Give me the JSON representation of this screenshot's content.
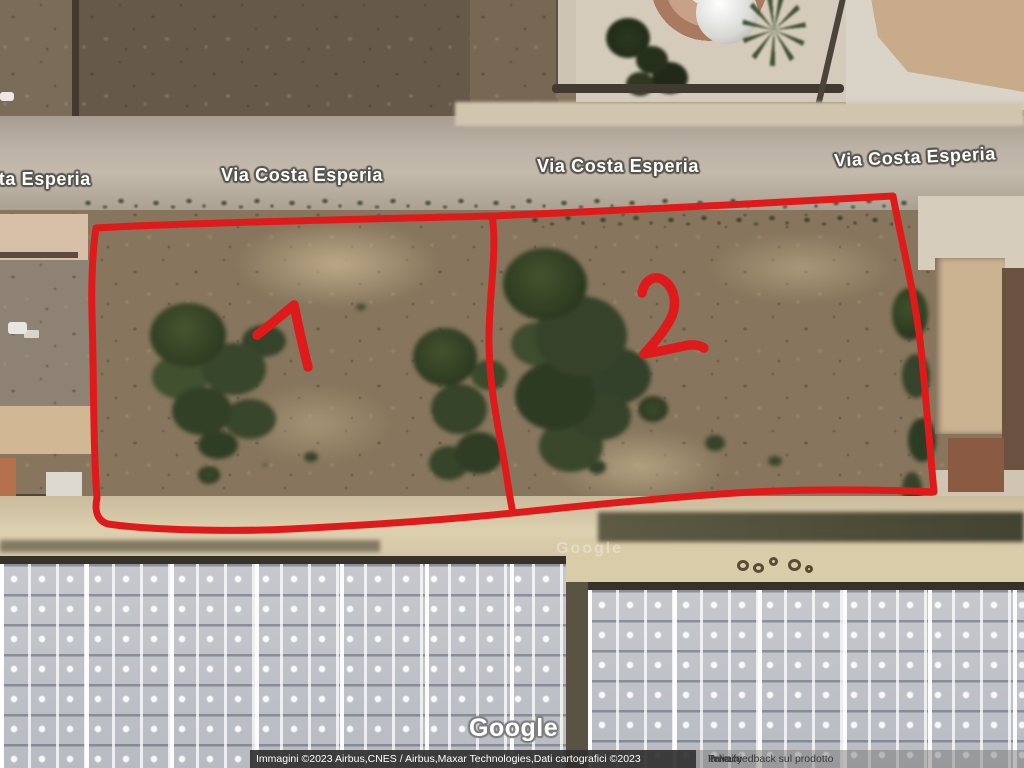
{
  "map": {
    "street_labels": [
      {
        "text": "Costa Esperia"
      },
      {
        "text": "Via Costa Esperia"
      },
      {
        "text": "Via Costa Esperia"
      },
      {
        "text": "Via Costa Esperia"
      }
    ],
    "parcels": [
      {
        "number": "1"
      },
      {
        "number": "2"
      }
    ],
    "annotation_color": "#e01a1a"
  },
  "watermark": {
    "logo": "Google",
    "ghost": "Google"
  },
  "attribution": {
    "imagery": "Immagini ©2023 Airbus,CNES / Airbus,Maxar Technologies,Dati cartografici ©2023",
    "links": [
      {
        "label": "Italia"
      },
      {
        "label": "Termini"
      },
      {
        "label": "Privacy"
      },
      {
        "label": "Invia feedback sul prodotto"
      }
    ]
  }
}
